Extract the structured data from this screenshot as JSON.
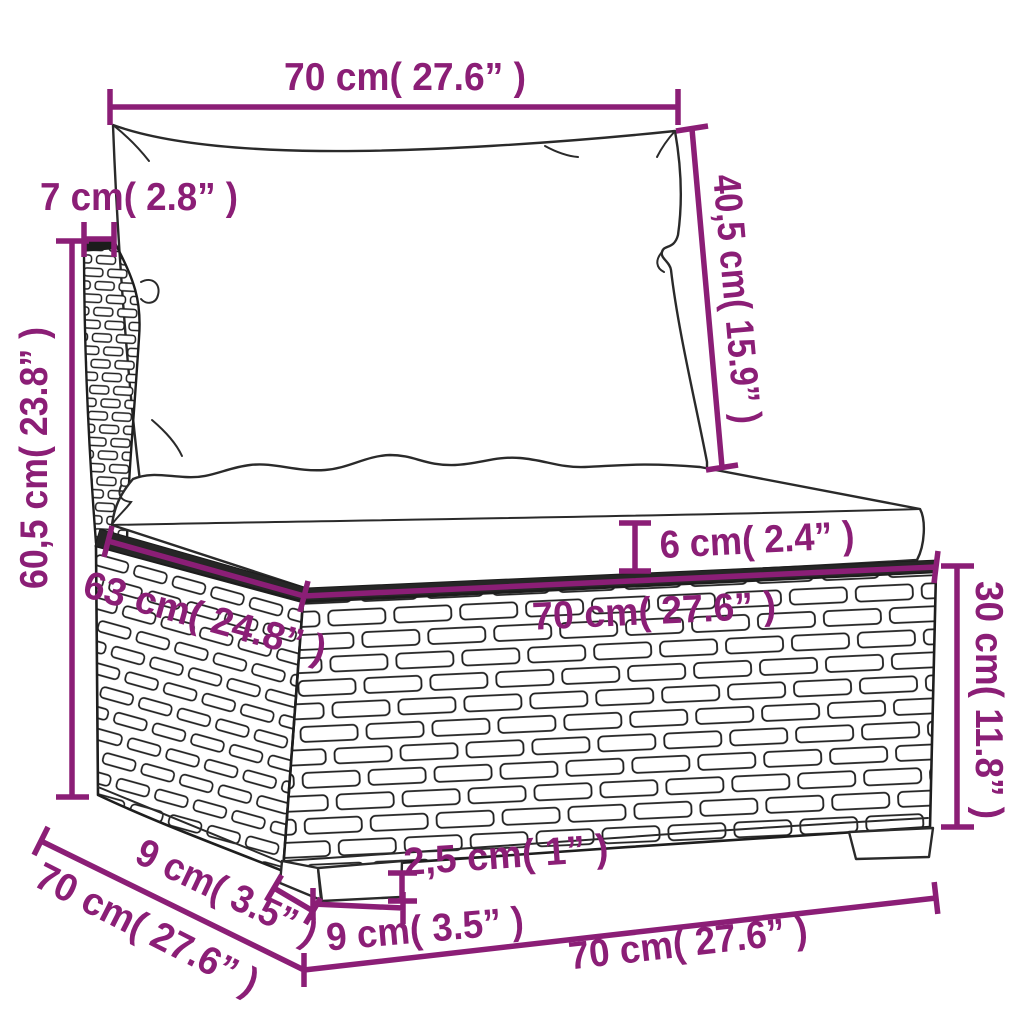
{
  "diagram": {
    "description": "Poly rattan garden sofa middle section with cushions - dimension drawing",
    "background": "#ffffff",
    "dimension_color": "#8B1E76",
    "line_art_color": "#2a2a2a",
    "labels": {
      "back_cushion_width": "70 cm( 27.6” )",
      "backrest_thickness": "7 cm( 2.8” )",
      "backrest_height": "60,5 cm( 23.8” )",
      "back_cushion_height": "40,5 cm( 15.9” )",
      "seat_cushion_thickness": "6 cm( 2.4” )",
      "seat_depth": "63 cm( 24.8” )",
      "seat_width": "70 cm( 27.6” )",
      "base_height": "30 cm( 11.8” )",
      "foot_depth": "9 cm( 3.5” )",
      "total_depth": "70 cm( 27.6” )",
      "foot_height": "2,5 cm( 1” )",
      "foot_width": "9 cm( 3.5” )",
      "total_width": "70 cm( 27.6” )"
    }
  }
}
